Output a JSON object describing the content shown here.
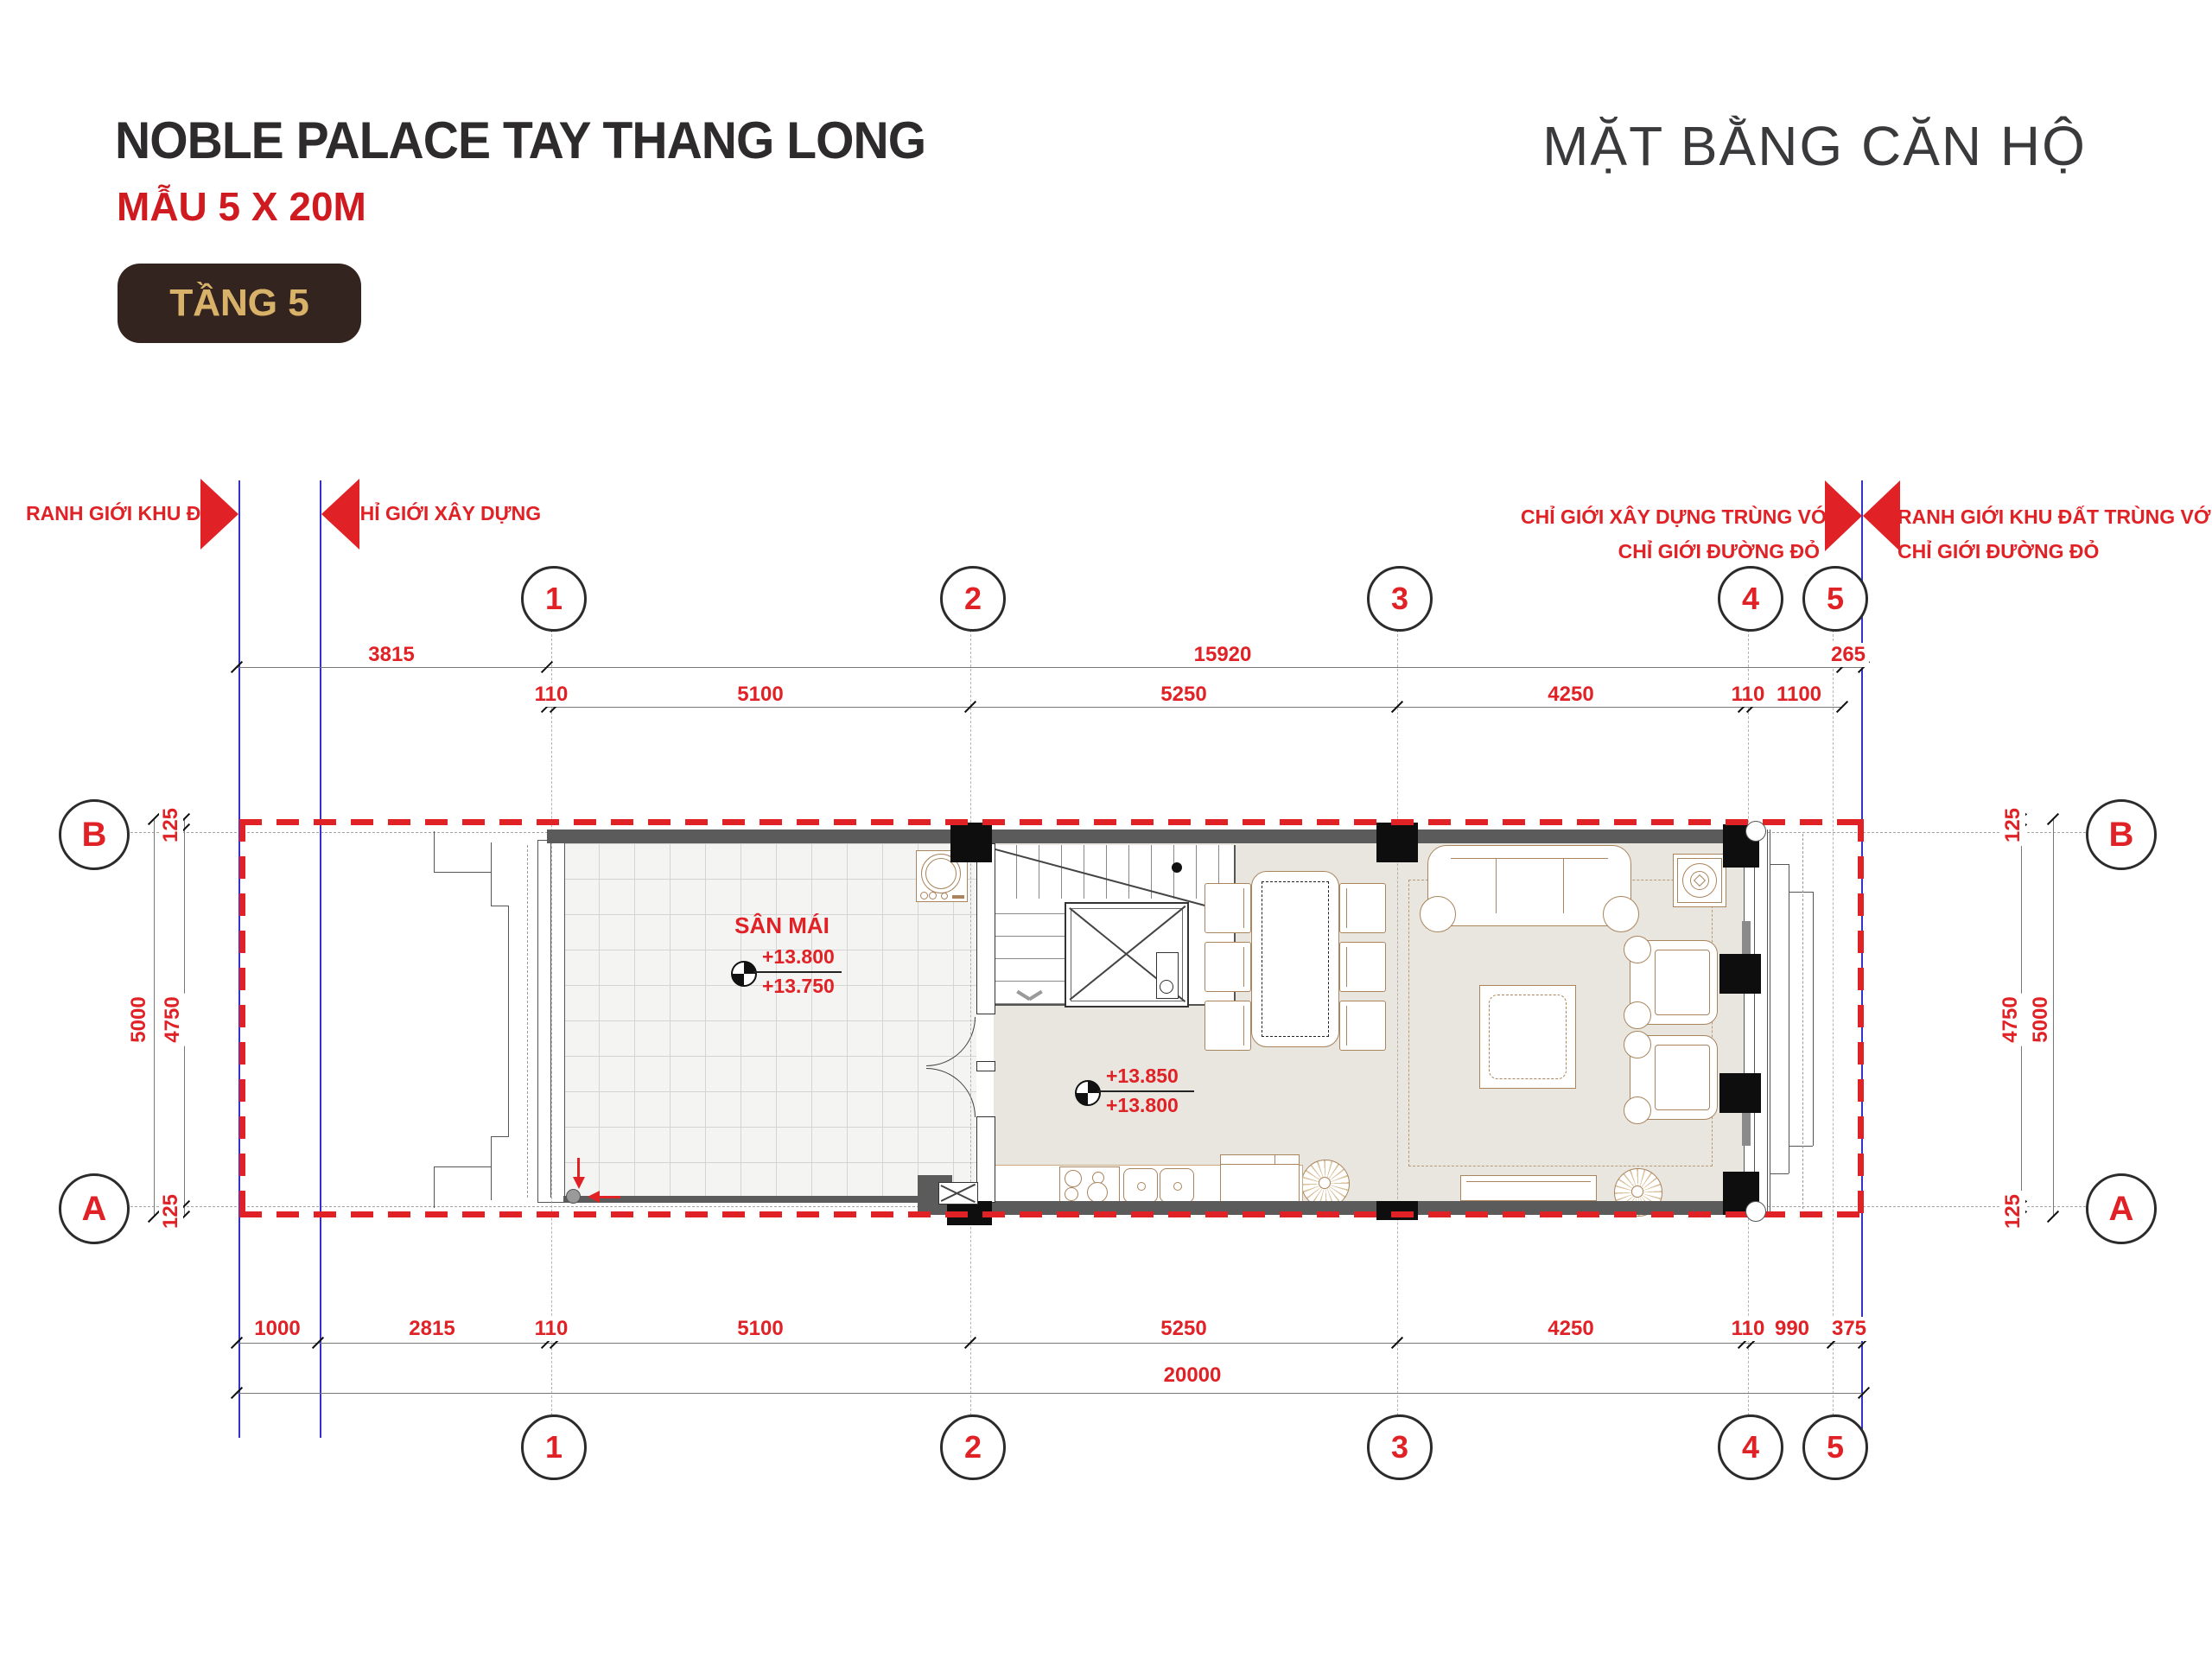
{
  "header": {
    "title": "NOBLE PALACE TAY THANG LONG",
    "subtitle": "MẪU 5 X 20M",
    "floor_badge": "TẦNG 5",
    "sheet_title": "MẶT BẰNG CĂN HỘ"
  },
  "boundary": {
    "left_outer": "RANH GIỚI KHU ĐẤT",
    "left_inner": "CHỈ GIỚI XÂY DỰNG",
    "right_inner_l1": "CHỈ GIỚI XÂY DỰNG TRÙNG VỚI",
    "right_inner_l2": "CHỈ GIỚI ĐƯỜNG ĐỎ",
    "right_outer_l1": "RANH GIỚI KHU ĐẤT TRÙNG VỚI",
    "right_outer_l2": "CHỈ GIỚI ĐƯỜNG ĐỎ"
  },
  "grid": {
    "cols": [
      "1",
      "2",
      "3",
      "4",
      "5"
    ],
    "rows": [
      "B",
      "A"
    ]
  },
  "dims": {
    "top1": [
      "3815",
      "15920",
      "265"
    ],
    "top2": [
      "110",
      "5100",
      "5250",
      "4250",
      "110",
      "1100"
    ],
    "bottom1": [
      "1000",
      "2815",
      "110",
      "5100",
      "5250",
      "4250",
      "110",
      "990",
      "375"
    ],
    "total": "20000",
    "left_off_top": "125",
    "left_inner": "4750",
    "left_outer": "5000",
    "left_off_bottom": "125",
    "right_off_top": "125",
    "right_inner": "4750",
    "right_outer": "5000",
    "right_off_bottom": "125"
  },
  "plan": {
    "terrace_label": "SÂN MÁI",
    "terrace_levels": [
      "+13.800",
      "+13.750"
    ],
    "living_levels": [
      "+13.850",
      "+13.800"
    ]
  },
  "colors": {
    "accent_red": "#e02125",
    "boundary_blue": "#3333cc",
    "wall_gray": "#5b5b5b",
    "floor_beige": "#e9e6e0",
    "furniture_brown": "#a9845c",
    "badge_bg": "#342420",
    "badge_text": "#d9b26a",
    "title_dark": "#2e2b2c"
  }
}
